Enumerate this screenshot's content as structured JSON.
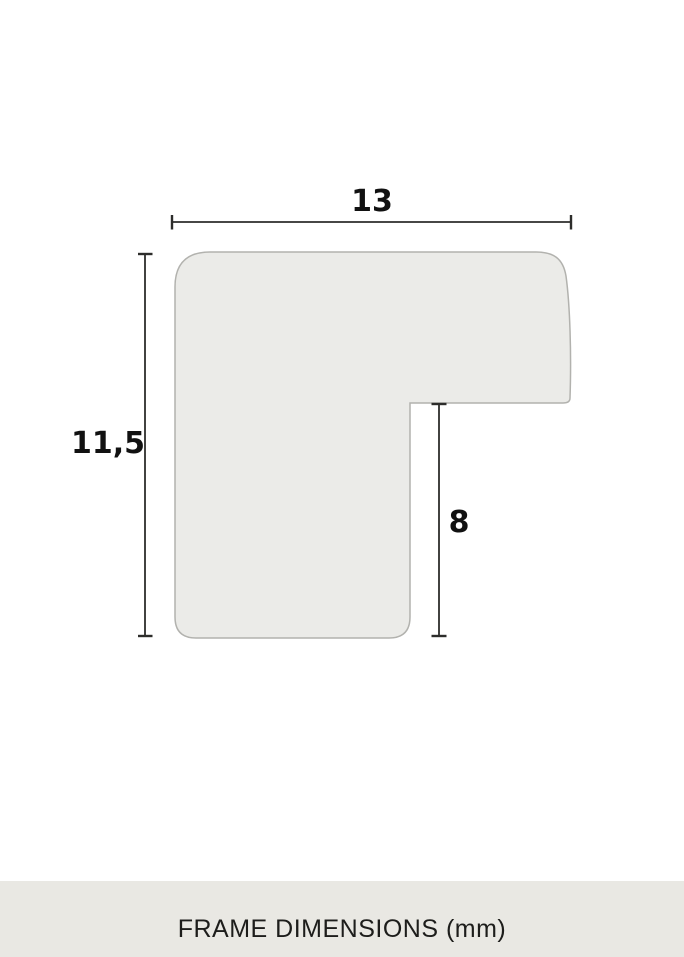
{
  "diagram": {
    "type": "frame-profile-cross-section",
    "dimensions": {
      "width_mm": "13",
      "height_mm": "11,5",
      "rabbet_depth_mm": "8"
    }
  },
  "footer": {
    "title": "FRAME DIMENSIONS (mm)"
  },
  "colors": {
    "background": "#ffffff",
    "profile_fill": "#ebebe8",
    "profile_border": "#b2b2ae",
    "dimension_line": "#2d2d2b",
    "label_text": "#111111",
    "footer_band": "#e9e8e3",
    "footer_text": "#1d1d1b"
  }
}
